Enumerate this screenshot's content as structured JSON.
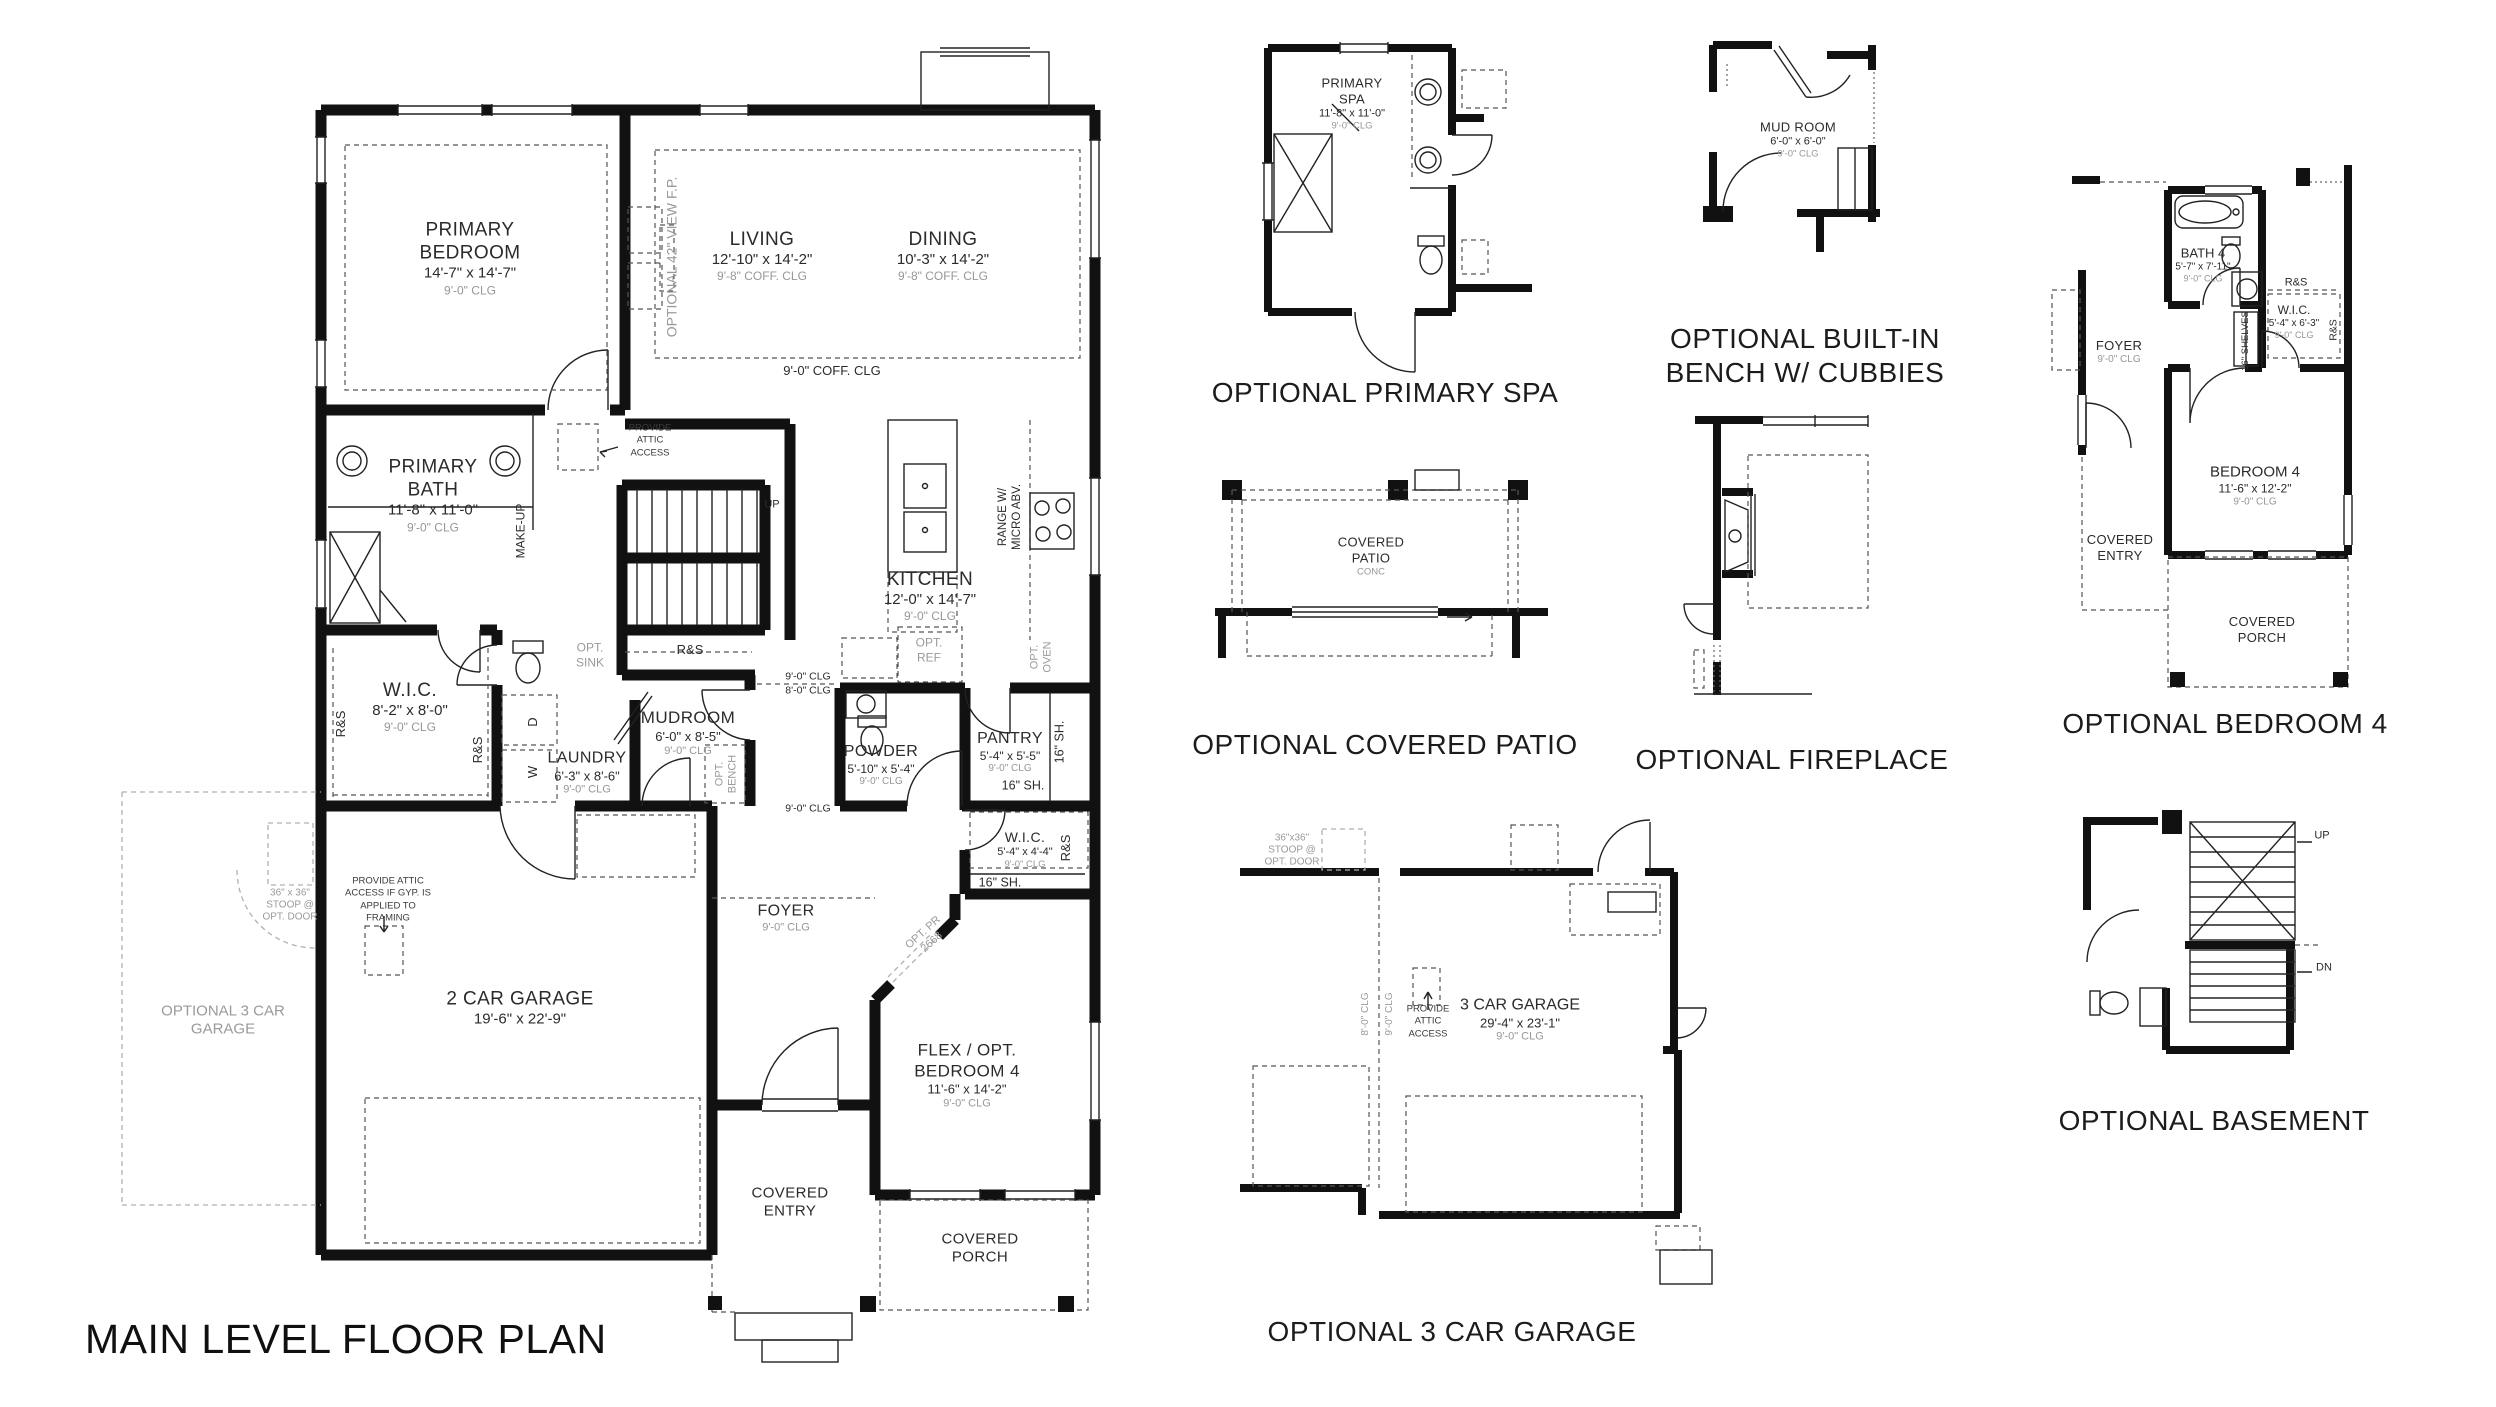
{
  "title": "MAIN LEVEL FLOOR PLAN",
  "colors": {
    "ink": "#111111",
    "gray": "#9a9a9a"
  },
  "main": {
    "rooms": {
      "primary_bedroom": {
        "name": "PRIMARY BEDROOM",
        "dims": "14'-7\" x 14'-7\"",
        "clg": "9'-0\" CLG"
      },
      "living": {
        "name": "LIVING",
        "dims": "12'-10\" x 14'-2\"",
        "clg": "9'-8\" COFF. CLG"
      },
      "dining": {
        "name": "DINING",
        "dims": "10'-3\" x 14'-2\"",
        "clg": "9'-8\" COFF. CLG"
      },
      "primary_bath": {
        "name": "PRIMARY BATH",
        "dims": "11'-8\" x 11'-0\"",
        "clg": "9'-0\" CLG"
      },
      "kitchen": {
        "name": "KITCHEN",
        "dims": "12'-0\" x 14'-7\"",
        "clg": "9'-0\" CLG"
      },
      "wic_primary": {
        "name": "W.I.C.",
        "dims": "8'-2\" x 8'-0\"",
        "clg": "9'-0\" CLG"
      },
      "laundry": {
        "name": "LAUNDRY",
        "dims": "6'-3\" x 8'-6\"",
        "clg": "9'-0\" CLG"
      },
      "mudroom": {
        "name": "MUDROOM",
        "dims": "6'-0\" x 8'-5\"",
        "clg": "9'-0\" CLG"
      },
      "powder": {
        "name": "POWDER",
        "dims": "5'-10\" x 5'-4\"",
        "clg": "9'-0\" CLG"
      },
      "pantry": {
        "name": "PANTRY",
        "dims": "5'-4\" x 5'-5\"",
        "clg": "9'-0\" CLG"
      },
      "wic_flex": {
        "name": "W.I.C.",
        "dims": "5'-4\" x 4'-4\"",
        "clg": "9'-0\" CLG"
      },
      "garage": {
        "name": "2 CAR GARAGE",
        "dims": "19'-6\" x 22'-9\""
      },
      "foyer": {
        "name": "FOYER",
        "clg": "9'-0\" CLG"
      },
      "flex": {
        "name": "FLEX / OPT. BEDROOM 4",
        "dims": "11'-6\" x 14'-2\"",
        "clg": "9'-0\" CLG"
      },
      "covered_entry": {
        "name": "COVERED ENTRY"
      },
      "covered_porch": {
        "name": "COVERED PORCH"
      }
    },
    "notes": {
      "opt_3car": "OPTIONAL 3 CAR GARAGE",
      "opt_view_fp": "OPTIONAL 42\" VIEW F.P.",
      "coff_clg": "9'-0\" COFF. CLG",
      "attic": "PROVIDE ATTIC ACCESS",
      "attic_gyp": "PROVIDE ATTIC ACCESS IF GYP. IS APPLIED TO FRAMING",
      "make_up": "MAKE-UP",
      "up": "UP",
      "rs": "R&S",
      "opt_sink": "OPT. SINK",
      "w": "W",
      "d": "D",
      "opt_bench": "OPT. BENCH",
      "range": "RANGE W/ MICRO ABV.",
      "opt_oven": "OPT. OVEN",
      "opt_ref": "OPT. REF",
      "clg9": "9'-0\" CLG",
      "clg8": "8'-0\" CLG",
      "sh16": "16\" SH.",
      "opt_pr": "OPT. PR 2668",
      "stoop": "36\" x 36\" STOOP @ OPT. DOOR"
    }
  },
  "panels": {
    "spa": {
      "caption": "OPTIONAL PRIMARY SPA",
      "room": {
        "name": "PRIMARY SPA",
        "dims": "11'-8\" x 11'-0\"",
        "clg": "9'-0\" CLG"
      }
    },
    "bench": {
      "caption": "OPTIONAL BUILT-IN BENCH W/ CUBBIES",
      "room": {
        "name": "MUD ROOM",
        "dims": "6'-0\" x 6'-0\"",
        "clg": "9'-0\" CLG"
      }
    },
    "patio": {
      "caption": "OPTIONAL COVERED PATIO",
      "room": {
        "name": "COVERED PATIO",
        "sub": "CONC"
      }
    },
    "fireplace": {
      "caption": "OPTIONAL FIREPLACE"
    },
    "bed4": {
      "caption": "OPTIONAL BEDROOM 4",
      "bath": {
        "name": "BATH 4",
        "dims": "5'-7\" x 7'-11\"",
        "clg": "9'-0\" CLG"
      },
      "foyer": {
        "name": "FOYER",
        "clg": "9'-0\" CLG"
      },
      "wic": {
        "name": "W.I.C.",
        "dims": "5'-4\" x 6'-3\"",
        "clg": "9'-0\" CLG"
      },
      "bedroom": {
        "name": "BEDROOM 4",
        "dims": "11'-6\" x 12'-2\"",
        "clg": "9'-0\" CLG"
      },
      "covered_entry": "COVERED ENTRY",
      "covered_porch": "COVERED PORCH",
      "shelves": "16\" SHELVES",
      "rs": "R&S"
    },
    "garage3": {
      "caption": "OPTIONAL 3 CAR GARAGE",
      "room": {
        "name": "3 CAR GARAGE",
        "dims": "29'-4\" x 23'-1\"",
        "clg": "9'-0\" CLG"
      },
      "stoop": "36\"x36\" STOOP @ OPT. DOOR",
      "clg8": "8'-0\" CLG",
      "clg9": "9'-0\" CLG",
      "attic": "PROVIDE ATTIC ACCESS"
    },
    "basement": {
      "caption": "OPTIONAL BASEMENT",
      "up": "UP",
      "dn": "DN"
    }
  }
}
